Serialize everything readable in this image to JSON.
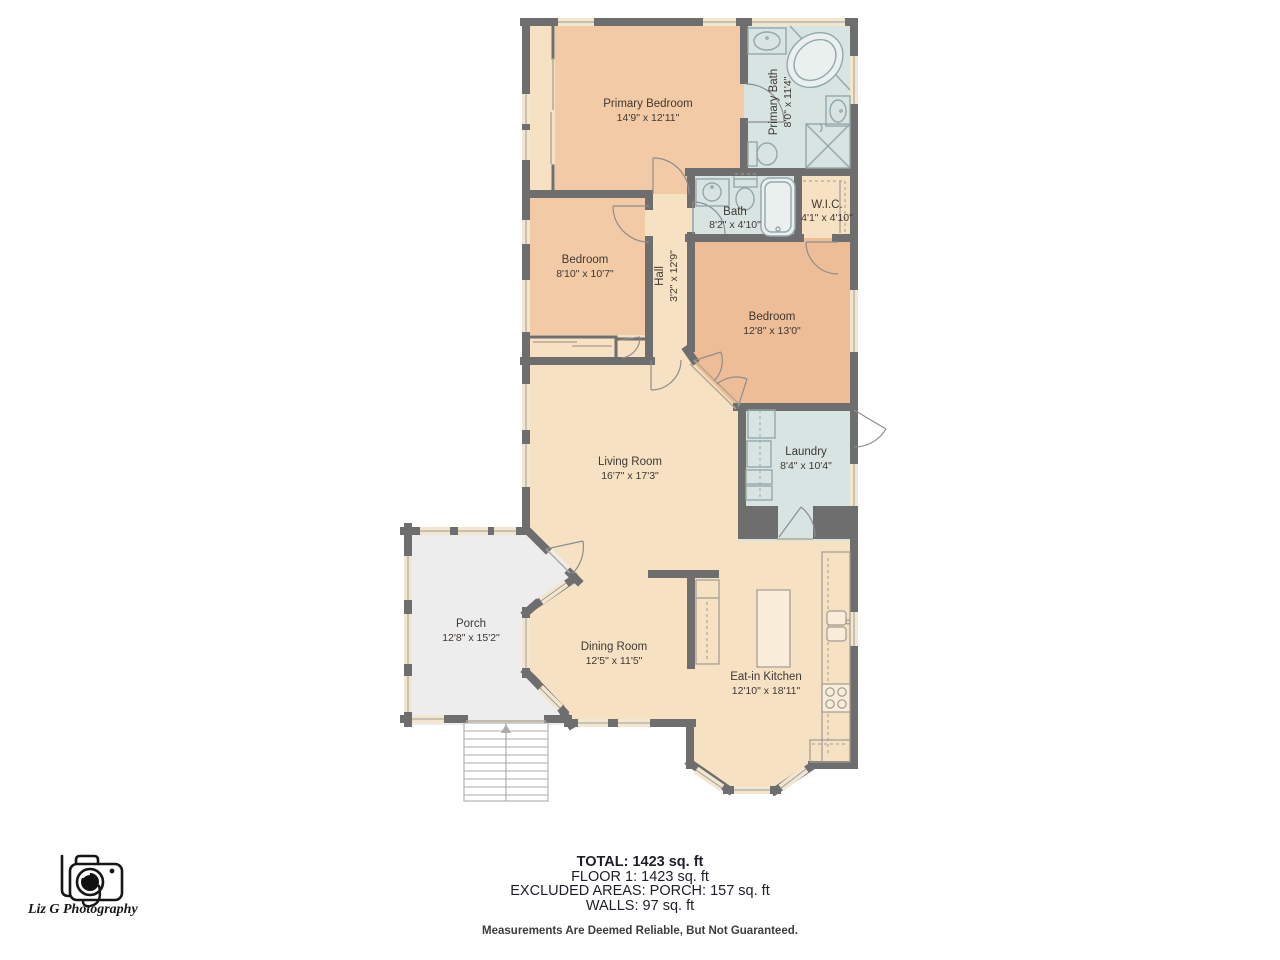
{
  "branding": {
    "logo_text": "Liz G Photography",
    "logo_icon": "camera-icon"
  },
  "rooms": [
    {
      "id": "primary-bedroom",
      "name": "Primary Bedroom",
      "dims": "14'9\" x 12'11\"",
      "fixtures": [
        "closet"
      ]
    },
    {
      "id": "primary-bath",
      "name": "Primary Bath",
      "dims": "8'0\" x 11'4\"",
      "fixtures": [
        "sink",
        "corner-tub",
        "sink",
        "toilet",
        "shower"
      ]
    },
    {
      "id": "bath",
      "name": "Bath",
      "dims": "8'2\" x 4'10\"",
      "fixtures": [
        "sink",
        "toilet",
        "bathtub"
      ]
    },
    {
      "id": "wic",
      "name": "W.I.C.",
      "dims": "4'1\" x 4'10\"",
      "fixtures": [
        "shelving"
      ]
    },
    {
      "id": "bedroom-2",
      "name": "Bedroom",
      "dims": "8'10\" x 10'7\"",
      "fixtures": [
        "closet"
      ]
    },
    {
      "id": "hall",
      "name": "Hall",
      "dims": "3'2\" x 12'9\"",
      "fixtures": []
    },
    {
      "id": "bedroom-3",
      "name": "Bedroom",
      "dims": "12'8\" x 13'0\"",
      "fixtures": []
    },
    {
      "id": "laundry",
      "name": "Laundry",
      "dims": "8'4\" x 10'4\"",
      "fixtures": [
        "washer",
        "dryer"
      ]
    },
    {
      "id": "living-room",
      "name": "Living Room",
      "dims": "16'7\" x 17'3\"",
      "fixtures": []
    },
    {
      "id": "porch",
      "name": "Porch",
      "dims": "12'8\" x 15'2\"",
      "fixtures": [
        "stairs"
      ]
    },
    {
      "id": "dining-room",
      "name": "Dining Room",
      "dims": "12'5\" x 11'5\"",
      "fixtures": []
    },
    {
      "id": "eat-in-kitchen",
      "name": "Eat-in Kitchen",
      "dims": "12'10\" x 18'11\"",
      "fixtures": [
        "counter",
        "sink",
        "stove",
        "island"
      ]
    }
  ],
  "summary": {
    "total": "TOTAL: 1423 sq. ft",
    "floor1": "FLOOR 1: 1423 sq. ft",
    "excluded": "EXCLUDED AREAS: PORCH: 157 sq. ft",
    "walls": "WALLS: 97 sq. ft",
    "disclaimer": "Measurements Are Deemed Reliable, But Not Guaranteed."
  },
  "colors": {
    "wall": "#6e6e6e",
    "floor": "#f6e2c3",
    "bedroom": "#f2cba6",
    "bedroom2": "#edbd97",
    "bath": "#d8e4e2",
    "porch": "#ededed",
    "window": "#f3e6cf",
    "fixture": "#93a7ab",
    "kfixture": "#a09a90",
    "text": "#3f3833",
    "summary": "#1e1e28",
    "disclaimer": "#3d3d3d",
    "logo": "#161616"
  }
}
